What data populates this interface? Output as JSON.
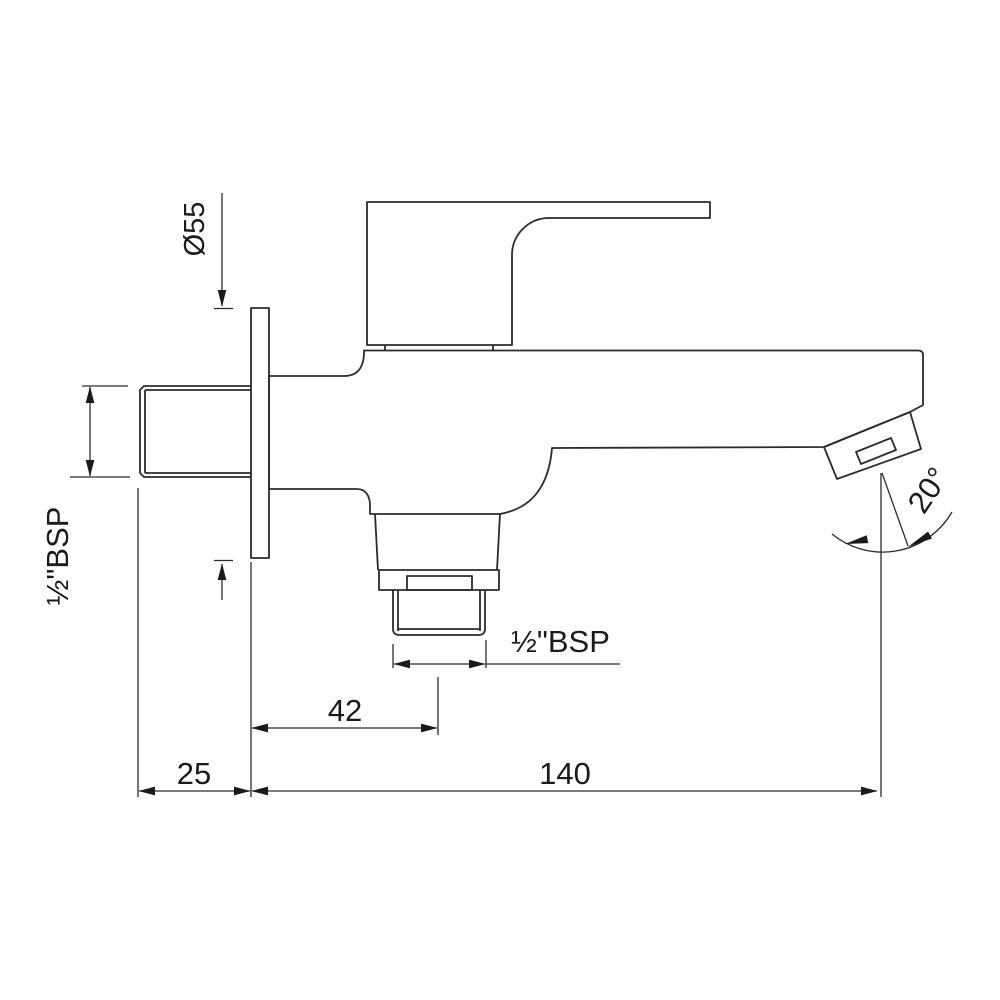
{
  "drawing": {
    "type": "technical-dimension-drawing",
    "subject": "wall-mounted bib cock faucet, side elevation",
    "background_color": "#ffffff",
    "line_color": "#2b2b2b",
    "labels": {
      "flange_diameter": "Ø55",
      "inlet_thread": "½\"BSP",
      "outlet_thread": "½\"BSP",
      "outlet_center_offset": "42",
      "wall_projection": "25",
      "spout_reach": "140",
      "spout_angle": "20°"
    }
  }
}
